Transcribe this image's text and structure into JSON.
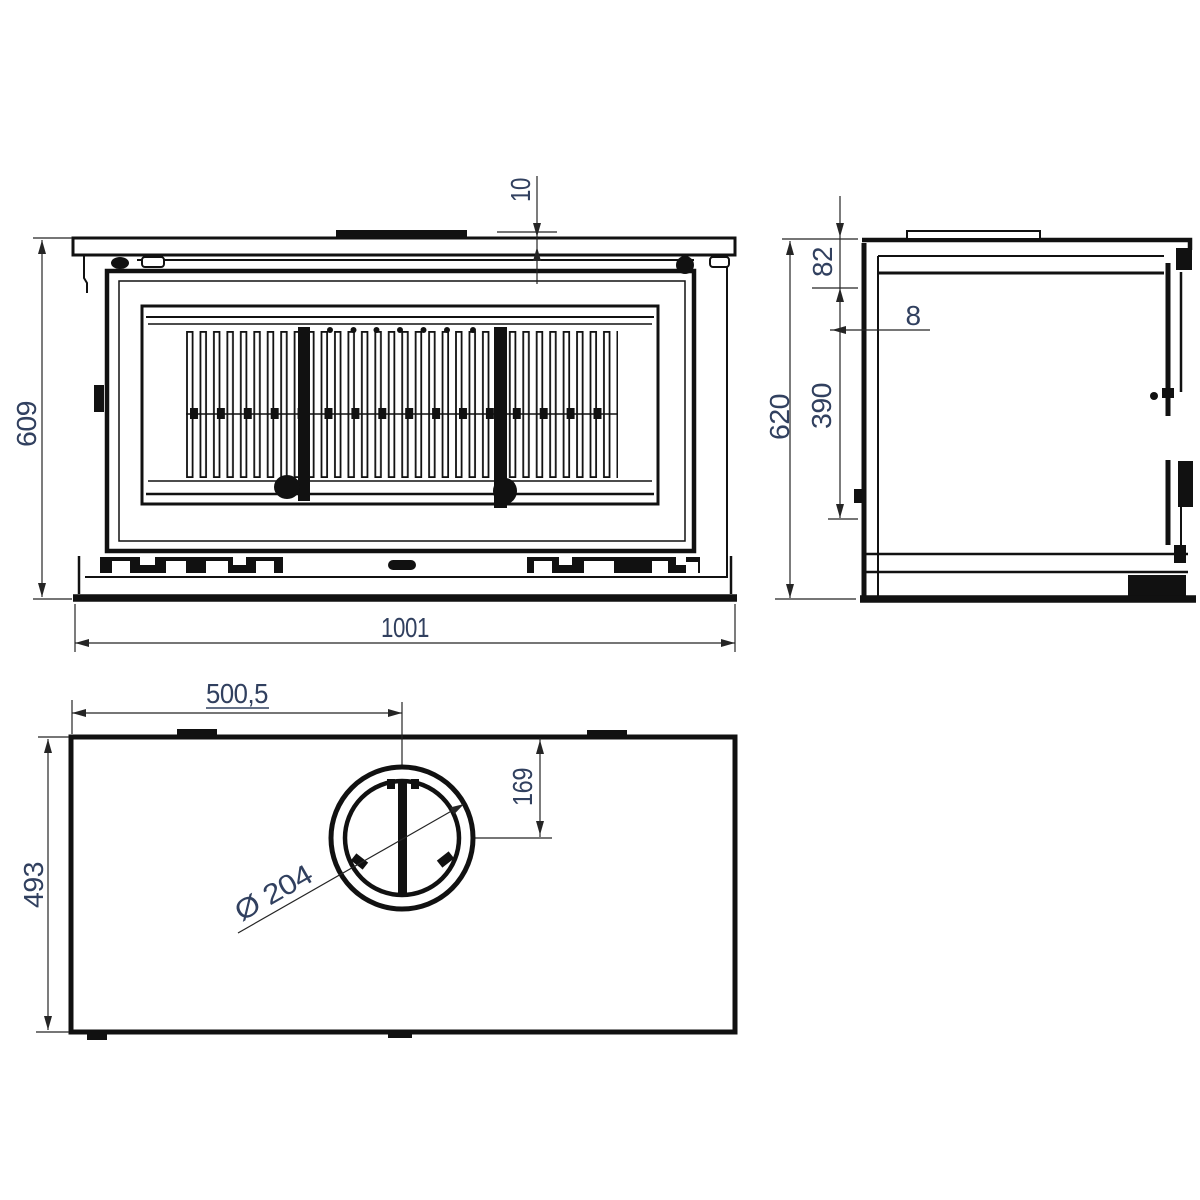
{
  "colors": {
    "line": "#111111",
    "dim_text": "#31405f"
  },
  "dimensions": {
    "front_top_plate_thickness": "10",
    "front_height": "609",
    "front_width": "1001",
    "side_top_section_height": "82",
    "side_front_wall_thickness": "8",
    "side_mid_height": "390",
    "side_total_height": "620",
    "top_flue_center_from_left": "500,5",
    "top_flue_center_from_front_edge": "169",
    "top_depth": "493",
    "top_flue_diameter": "Ø 204"
  }
}
